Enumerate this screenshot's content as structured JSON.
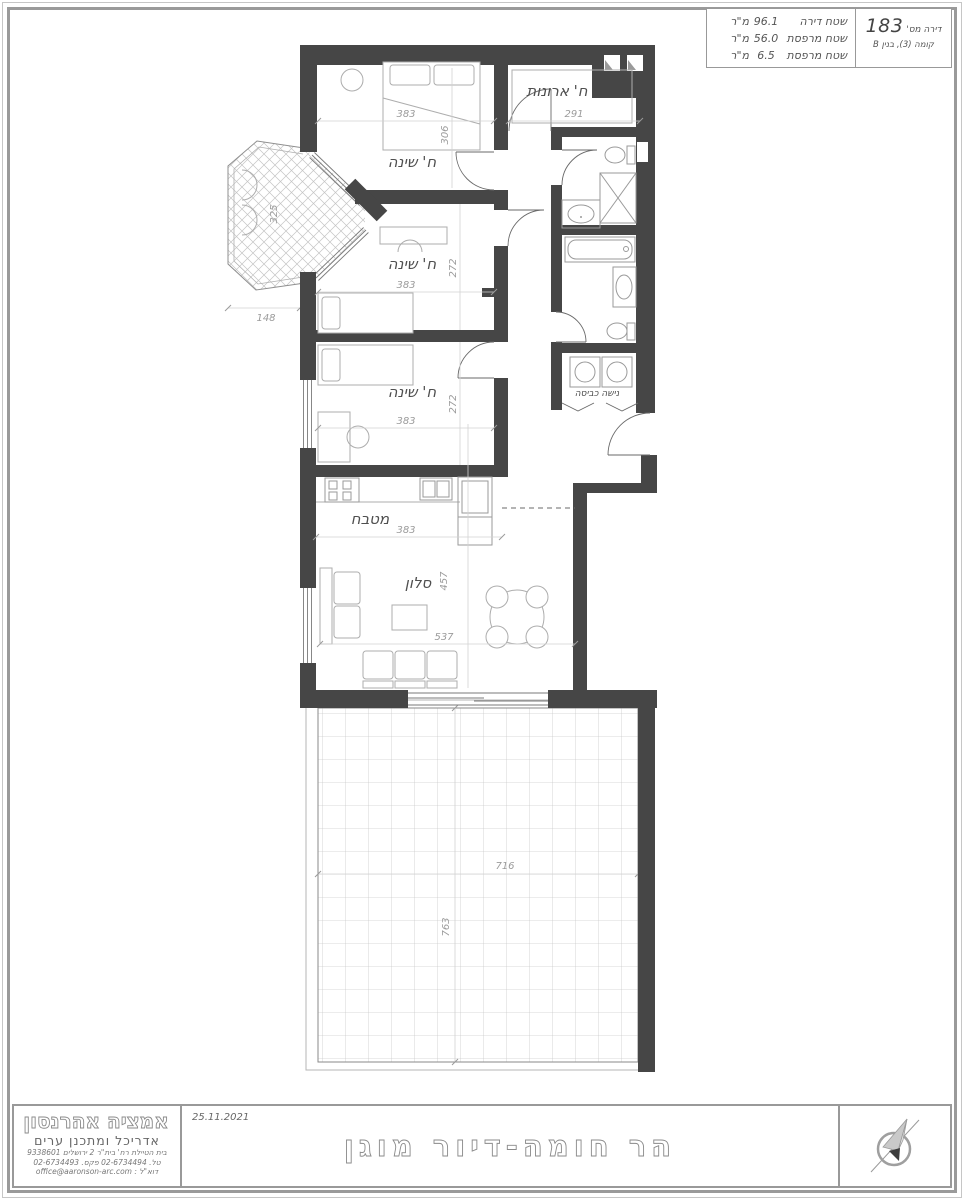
{
  "info_box": {
    "apt_label": "דירה מס'",
    "apt_number": "183",
    "floor_line": "קומה (3), בנין B",
    "areas": [
      {
        "label": "שטח דירה",
        "value": "96.1",
        "unit": "מ\"ר"
      },
      {
        "label": "שטח מרפסת",
        "value": "56.0",
        "unit": "מ\"ר"
      },
      {
        "label": "שטח מרפסת",
        "value": "6.5",
        "unit": "מ\"ר"
      }
    ]
  },
  "plan": {
    "labels": {
      "bedroom1": "ח' שינה",
      "closet": "ח' ארונות",
      "bedroom2": "ח' שינה",
      "bedroom3": "ח' שינה",
      "kitchen": "מטבח",
      "living": "סלון",
      "laundry": "נישה כביסה"
    },
    "dims": {
      "bed1_w": "383",
      "bed1_d": "306",
      "closet_w": "291",
      "bay_w": "325",
      "bay_off": "148",
      "bed2_w": "383",
      "bed2_d": "272",
      "bed3_w": "383",
      "bed3_d": "272",
      "kitchen_w": "383",
      "living_d": "457",
      "living_w": "537",
      "terrace_w": "716",
      "terrace_d": "763"
    }
  },
  "title_block": {
    "architect_name": "אמציה אהרנסון",
    "architect_title": "אדריכל ומתכנן ערים",
    "address": "בית הטיילת  רח' בית\"ר 2  ירושלים  9338601",
    "phone": "טל. 02-6734494  פקס. 02-6734493",
    "email": "דוא\"ל :  office@aaronson-arc.com",
    "date": "25.11.2021",
    "project_title": "הר  חומה-דיור  מוגן"
  },
  "colors": {
    "wall": "#464646",
    "fixture_line": "#9a9a9a",
    "dim_text": "#9b9b9b",
    "border_gray": "#999999"
  }
}
